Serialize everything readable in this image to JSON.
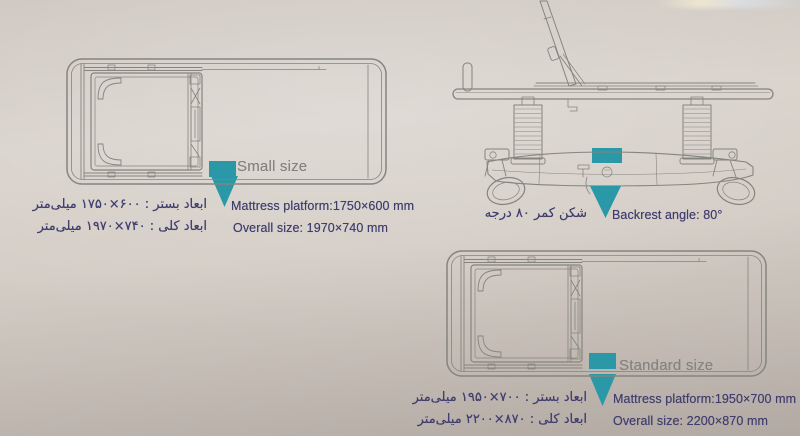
{
  "colors": {
    "accent": "#2a98a7",
    "spec_text": "#413e6f",
    "label_text": "#84837f",
    "line": "#85847e"
  },
  "small_bed": {
    "size_label": "Small size",
    "mattress": {
      "fa_label": "ابعاد بستر :",
      "fa_value": "۱۷۵۰×۶۰۰",
      "fa_unit": "میلی‌متر",
      "en": "Mattress platform:1750×600 mm"
    },
    "overall": {
      "fa_label": "ابعاد کلی :",
      "fa_value": "۱۹۷۰×۷۴۰",
      "fa_unit": "میلی‌متر",
      "en": "Overall size: 1970×740 mm"
    }
  },
  "backrest": {
    "fa_label": "شکن کمر",
    "fa_value": "۸۰",
    "fa_unit": "درجه",
    "en": "Backrest angle: 80°"
  },
  "standard_bed": {
    "size_label": "Standard size",
    "mattress": {
      "fa_label": "ابعاد بستر :",
      "fa_value": "۱۹۵۰×۷۰۰",
      "fa_unit": "میلی‌متر",
      "en": "Mattress platform:1950×700 mm"
    },
    "overall": {
      "fa_label": "ابعاد کلی :",
      "fa_value": "۲۲۰۰×۸۷۰",
      "fa_unit": "میلی‌متر",
      "en": "Overall size: 2200×870 mm"
    }
  }
}
